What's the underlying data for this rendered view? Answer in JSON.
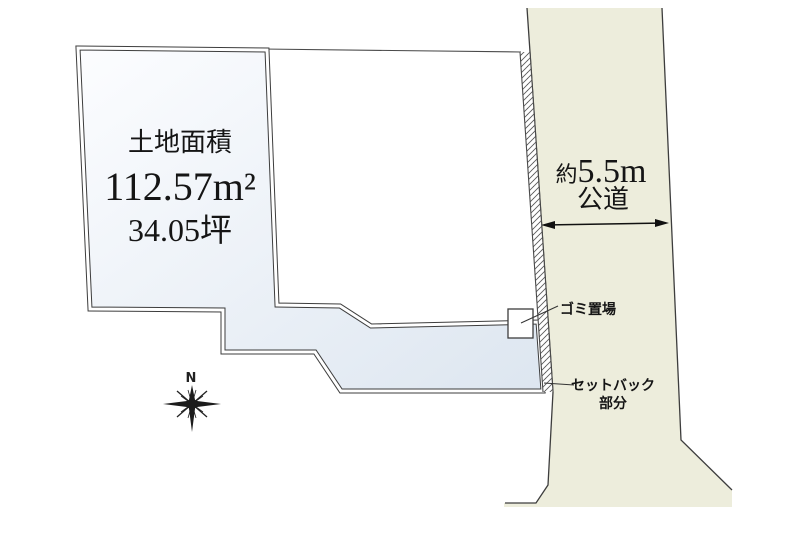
{
  "diagram": {
    "plot": {
      "area_title": "土地面積",
      "area_m2": "112.57m²",
      "area_tsubo": "34.05坪"
    },
    "road": {
      "width_prefix": "約",
      "width_value": "5.5m",
      "type_label": "公道"
    },
    "annotations": {
      "garbage": "ゴミ置場",
      "setback_line1": "セットバック",
      "setback_line2": "部分"
    },
    "compass": {
      "north": "N"
    },
    "colors": {
      "plot_fill_light": "#fcfdff",
      "plot_fill_dark": "#dde6f0",
      "road_fill": "#ededdc",
      "line": "#3d3d3d"
    }
  }
}
